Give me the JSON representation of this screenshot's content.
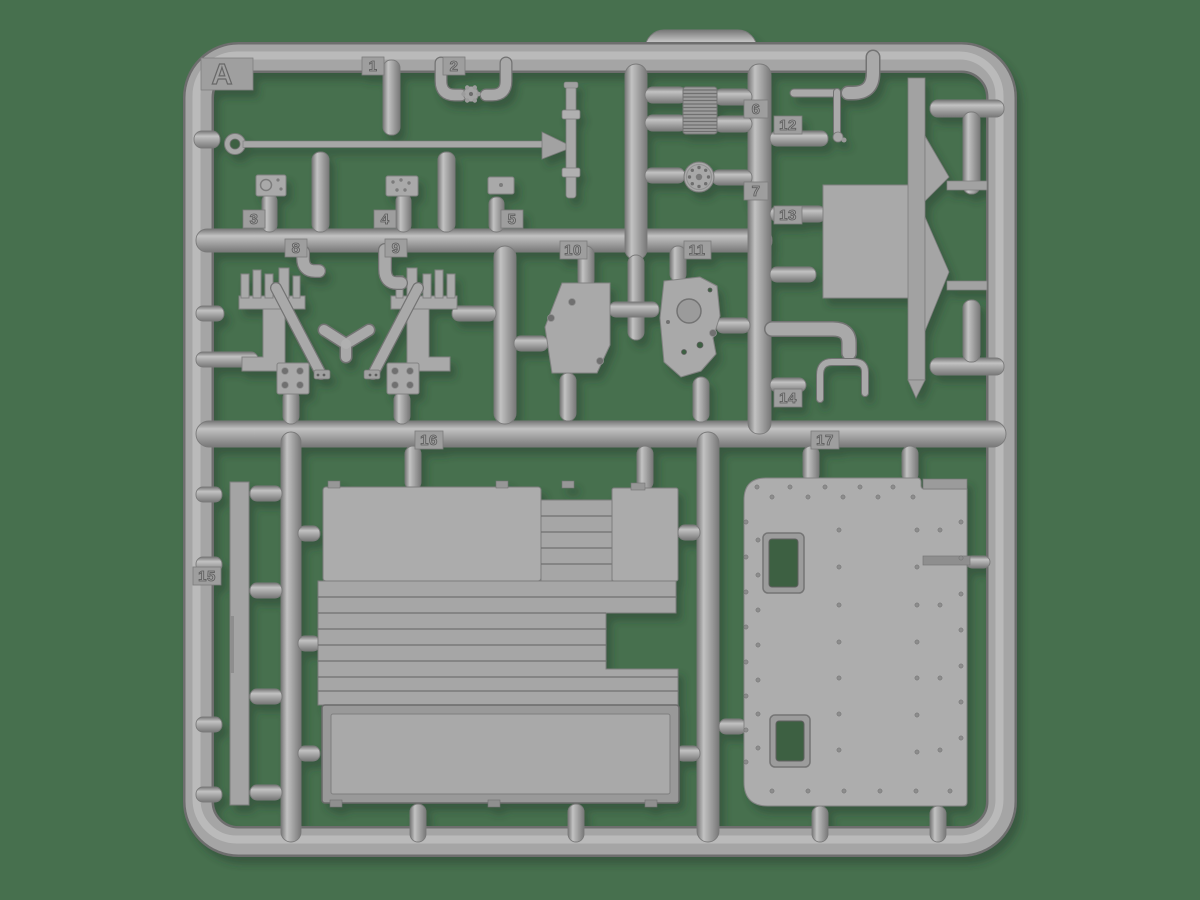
{
  "sprue": {
    "letter": "A"
  },
  "part_labels": [
    "1",
    "2",
    "3",
    "4",
    "5",
    "6",
    "7",
    "8",
    "9",
    "10",
    "11",
    "12",
    "13",
    "14",
    "15",
    "16",
    "17"
  ],
  "colors": {
    "background": "#47704e",
    "plastic": "#a8a8a8",
    "plastic_light": "#c2c2c2",
    "plastic_dark": "#787878",
    "plate": "#a9a9a9",
    "shadow": "#223b2a"
  }
}
